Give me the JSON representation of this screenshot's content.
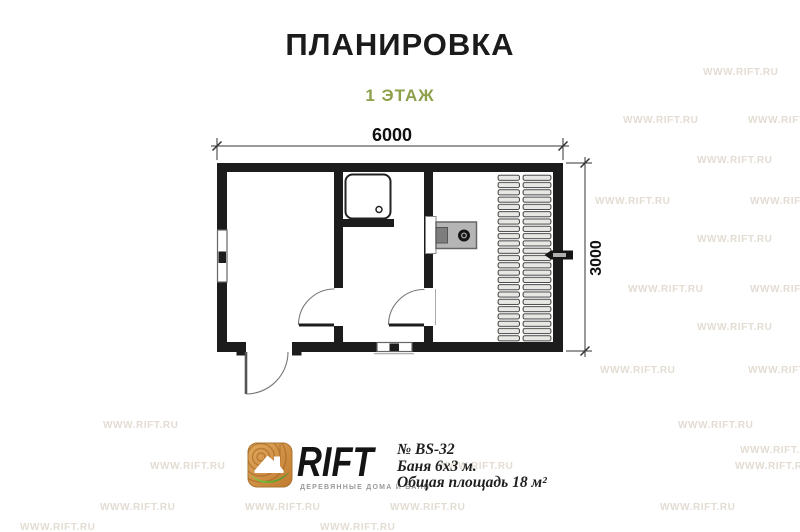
{
  "page": {
    "title": "ПЛАНИРОВКА",
    "subtitle": "1 ЭТАЖ"
  },
  "dimensions": {
    "width_label": "6000",
    "height_label": "3000"
  },
  "branding": {
    "logo_text": "RIFT",
    "tagline": "ДЕРЕВЯННЫЕ ДОМА И БАНИ"
  },
  "project": {
    "number": "№ BS-32",
    "name": "Баня 6х3 м.",
    "area": "Общая площадь 18 м²"
  },
  "watermark": {
    "text": "WWW.RIFT.RU",
    "positions": [
      [
        703,
        67
      ],
      [
        623,
        115
      ],
      [
        748,
        115
      ],
      [
        697,
        155
      ],
      [
        595,
        196
      ],
      [
        750,
        196
      ],
      [
        697,
        234
      ],
      [
        628,
        284
      ],
      [
        750,
        284
      ],
      [
        697,
        322
      ],
      [
        600,
        365
      ],
      [
        748,
        365
      ],
      [
        103,
        420
      ],
      [
        678,
        420
      ],
      [
        740,
        445
      ],
      [
        150,
        461
      ],
      [
        438,
        461
      ],
      [
        735,
        461
      ],
      [
        100,
        502
      ],
      [
        245,
        502
      ],
      [
        390,
        502
      ],
      [
        660,
        502
      ],
      [
        20,
        522
      ],
      [
        320,
        522
      ]
    ]
  },
  "colors": {
    "wall": "#1c1c1c",
    "accent_green": "#8da04b",
    "watermark": "#d4cabb",
    "bench_fill": "#e7e7e4",
    "stove_fill": "#b5b5b5"
  }
}
